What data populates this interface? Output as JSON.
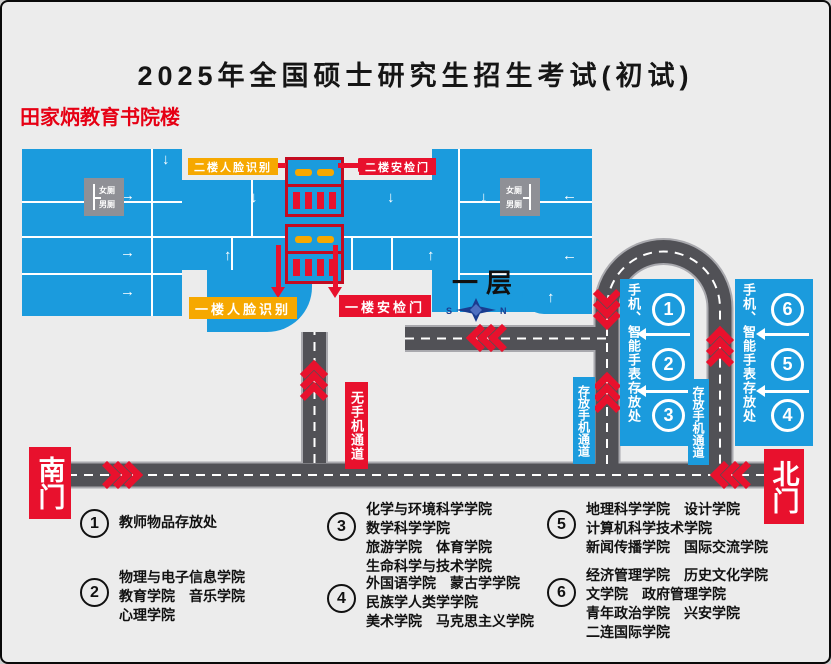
{
  "title": "2025年全国硕士研究生招生考试(初试)",
  "building_name": "田家炳教育书院楼",
  "floor_label": "一层",
  "toilets": {
    "female": "女厕",
    "male": "男厕"
  },
  "compass": {
    "left": "S",
    "right": "N"
  },
  "checkpoints": {
    "face_2f": "二楼人脸识别",
    "security_2f": "二楼安检门",
    "face_1f": "一楼人脸识别",
    "security_1f": "一楼安检门"
  },
  "channels": {
    "no_phone": "无手机通道",
    "store_phone": "存放手机通道"
  },
  "storage_panels": {
    "label": "手机、智能手表存放处",
    "left_numbers": [
      "1",
      "2",
      "3"
    ],
    "right_numbers": [
      "6",
      "5",
      "4"
    ]
  },
  "gates": {
    "south": "南门",
    "north": "北门"
  },
  "legend": [
    {
      "num": "1",
      "lines": [
        "教师物品存放处"
      ]
    },
    {
      "num": "2",
      "lines": [
        "物理与电子信息学院",
        "教育学院　音乐学院",
        "心理学院"
      ]
    },
    {
      "num": "3",
      "lines": [
        "化学与环境科学学院",
        "数学科学学院",
        "旅游学院　体育学院",
        "生命科学与技术学院"
      ]
    },
    {
      "num": "4",
      "lines": [
        "外国语学院　蒙古学学院",
        "民族学人类学学院",
        "美术学院　马克思主义学院"
      ]
    },
    {
      "num": "5",
      "lines": [
        "地理科学学院　设计学院",
        "计算机科学技术学院",
        "新闻传播学院　国际交流学院"
      ]
    },
    {
      "num": "6",
      "lines": [
        "经济管理学院　历史文化学院",
        "文学院　政府管理学院",
        "青年政治学院　兴安学院",
        "二连国际学院"
      ]
    }
  ],
  "icons": {
    "arrow_up": "↑",
    "arrow_down": "↓",
    "arrow_left": "←",
    "arrow_right": "→"
  },
  "colors": {
    "building_blue": "#1b9bdd",
    "accent_red": "#e8112d",
    "accent_orange": "#f6a800",
    "road_gray": "#515156"
  }
}
